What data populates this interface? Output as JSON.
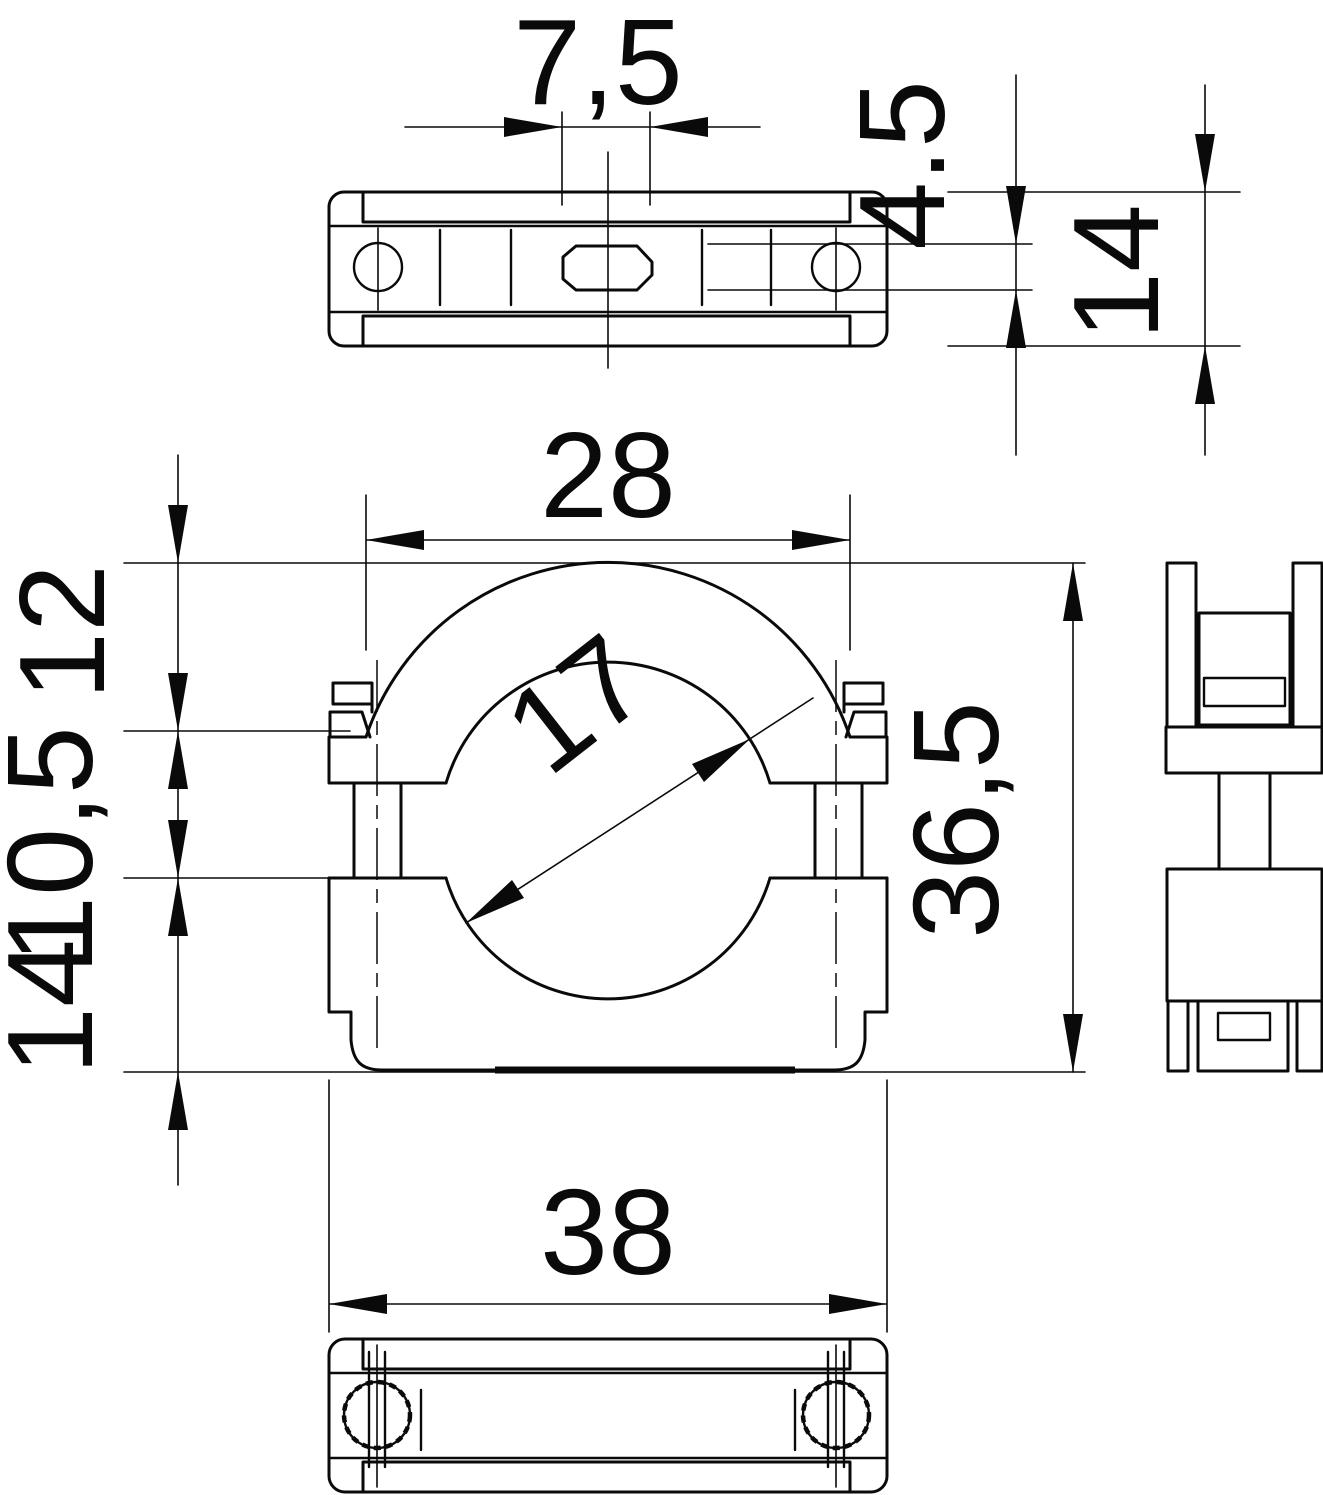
{
  "page": {
    "background_color": "#ffffff",
    "line_color": "#0a0a0a"
  },
  "drawing": {
    "kind": "technical-dimension-drawing",
    "subject": "two-piece pipe clamp shown in four orthographic views",
    "views": [
      {
        "id": "top-view",
        "label": "top view"
      },
      {
        "id": "front-view",
        "label": "front view"
      },
      {
        "id": "side-view",
        "label": "side view"
      },
      {
        "id": "bottom-view",
        "label": "bottom view"
      }
    ],
    "dimensions": {
      "slot_width": "7,5",
      "mounting_hole": "4.5",
      "depth": "14",
      "upper_body_width": "28",
      "upper_section_height": "12",
      "gap_height": "10,5",
      "lower_section_height": "14",
      "bore_diameter": "17",
      "overall_height": "36,5",
      "overall_width": "38"
    }
  }
}
